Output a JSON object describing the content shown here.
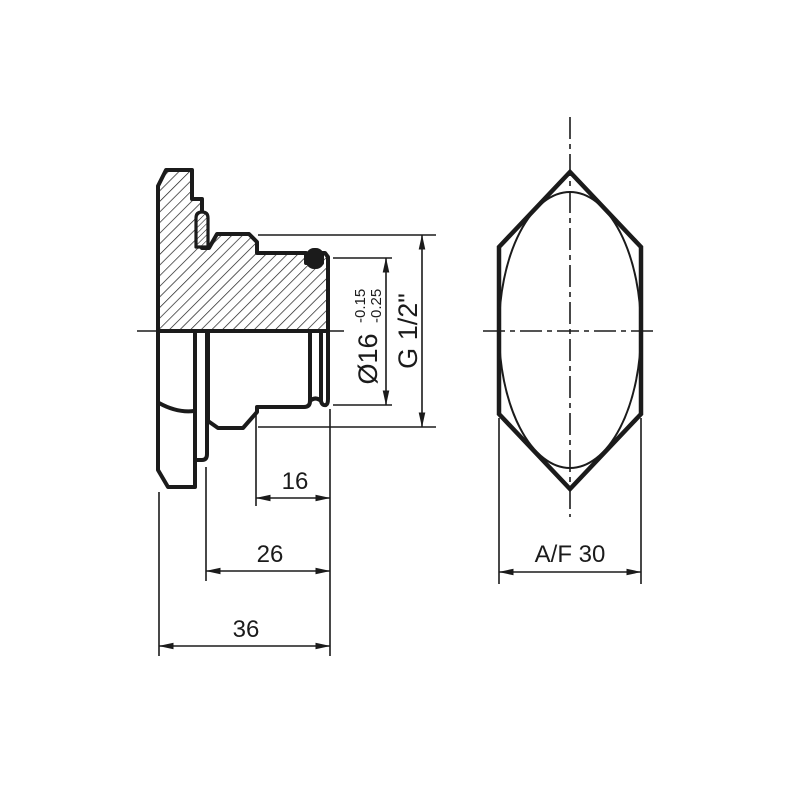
{
  "colors": {
    "ink": "#1b1b1b",
    "background": "#ffffff"
  },
  "dims": {
    "len_thread": "16",
    "len_shoulder": "26",
    "len_overall": "36",
    "dia_spigot": "Ø16",
    "dia_tol_upper": "-0.15",
    "dia_tol_lower": "-0.25",
    "thread_size": "G 1/2\"",
    "across_flats": "A/F 30"
  }
}
